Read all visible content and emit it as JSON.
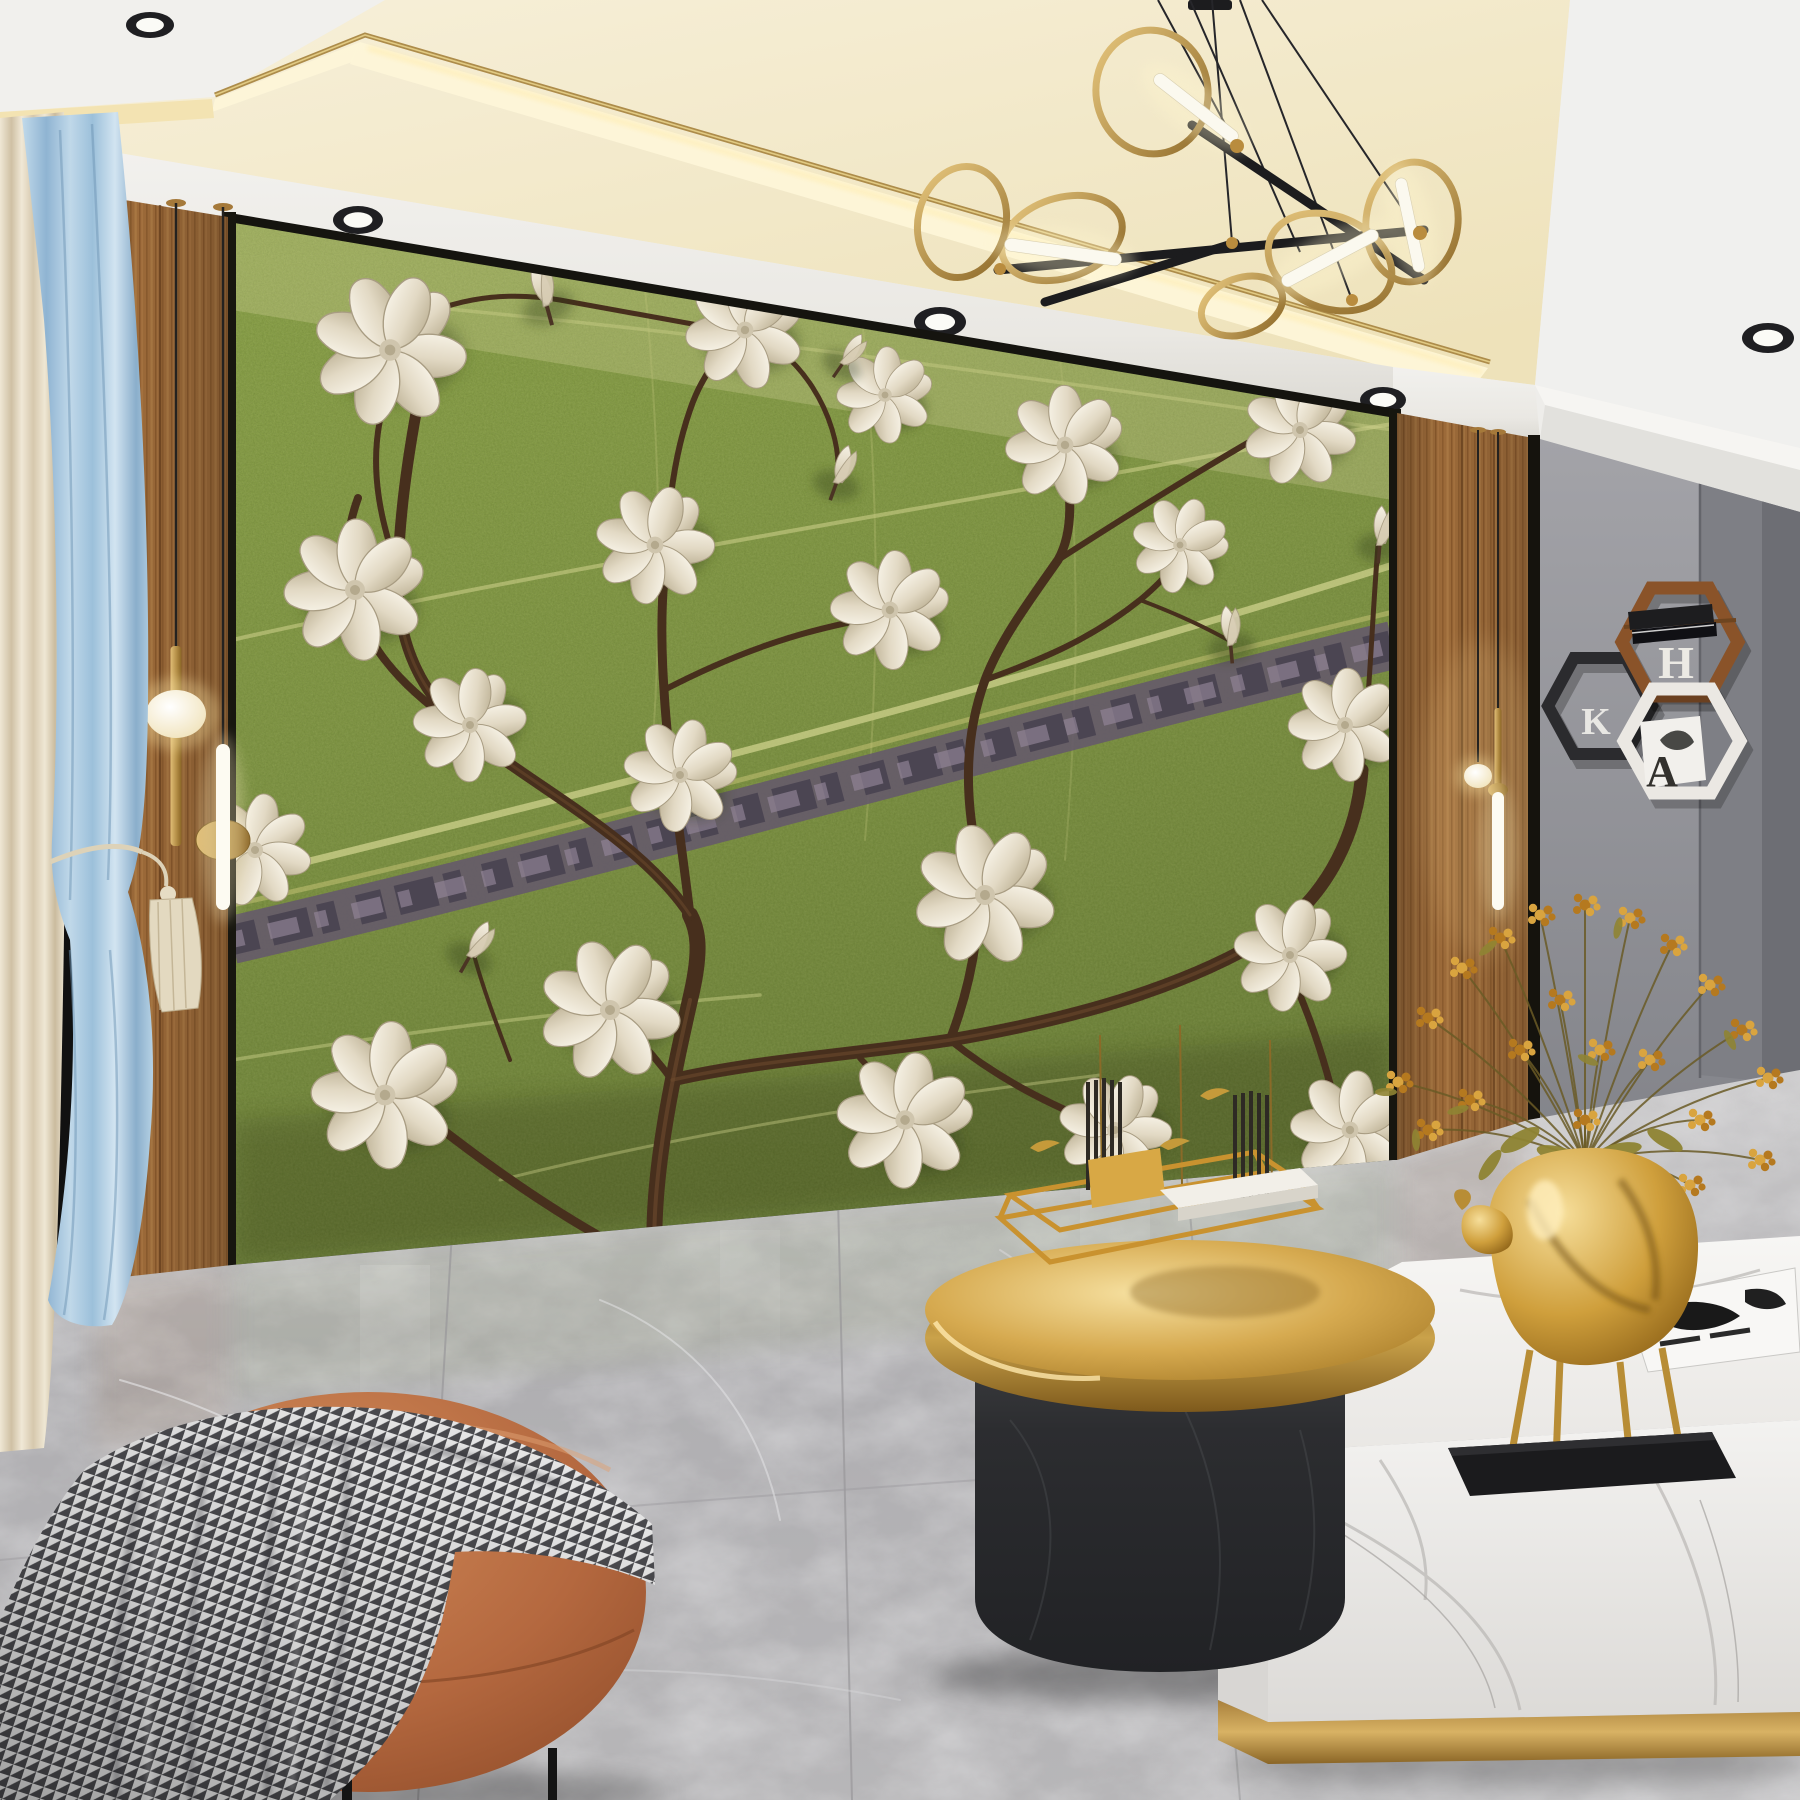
{
  "scene": {
    "description": "Modern living room render: green leaf-texture feature wall with embossed white magnolia branches, flanked by walnut wood panels, brass pendant lights, ring chandelier, gray marble floor, gold round coffee table with sculpture, white marble table with gold deer vase and yellow berry arrangement, caramel ottoman with houndstooth throw, blue and cream curtains, hexagon wall shelves."
  },
  "shelves": {
    "letter_top": "H",
    "letter_left": "K",
    "letter_bottom": "A"
  },
  "palette": {
    "ceiling_white": "#f1f0ed",
    "ceiling_cream": "#f6efd8",
    "cove_glow": "#fdf6d8",
    "gold_trim": "#ad8c4a",
    "mural_green": "#7d9440",
    "mural_green_dark": "#5d7030",
    "vein_yellow": "#cfd28c",
    "midrib_purple": "#655a6a",
    "branch_brown": "#472f1d",
    "petal_cream": "#f3eee1",
    "wood": "#9c6a39",
    "gray_wall": "#9c9ba0",
    "floor_gray": "#b4b3b5",
    "curtain_blue": "#a9c9e0",
    "curtain_cream": "#e9e0cc",
    "ottoman": "#b4683f",
    "blanket_dark": "#4a4a4e",
    "gold_bright": "#e8c06c",
    "black_marble": "#2d2e31",
    "white_marble": "#f5f4f2",
    "deer_gold": "#cf9f3c",
    "berry_yellow": "#d9a43f"
  },
  "ceiling": {
    "spotlights": [
      {
        "x": 150,
        "y": 25,
        "rx": 24,
        "ry": 13
      },
      {
        "x": 358,
        "y": 220,
        "rx": 25,
        "ry": 14
      },
      {
        "x": 940,
        "y": 322,
        "rx": 26,
        "ry": 15
      },
      {
        "x": 1383,
        "y": 400,
        "rx": 23,
        "ry": 13
      },
      {
        "x": 1768,
        "y": 338,
        "rx": 26,
        "ry": 15
      }
    ]
  },
  "chandelier": {
    "wires": [
      [
        1158,
        0,
        1237,
        146
      ],
      [
        1190,
        0,
        1300,
        252
      ],
      [
        1212,
        0,
        1232,
        242
      ],
      [
        1240,
        0,
        1352,
        300
      ],
      [
        1262,
        0,
        1420,
        235
      ]
    ],
    "bars": [
      [
        998,
        270,
        1424,
        230
      ],
      [
        1192,
        125,
        1424,
        280
      ],
      [
        1045,
        302,
        1235,
        243
      ]
    ],
    "rings": [
      {
        "cx": 1152,
        "cy": 92,
        "rx": 56,
        "ry": 62,
        "rot": -8
      },
      {
        "cx": 1062,
        "cy": 238,
        "rx": 62,
        "ry": 40,
        "rot": -18
      },
      {
        "cx": 962,
        "cy": 222,
        "rx": 44,
        "ry": 56,
        "rot": 12
      },
      {
        "cx": 1330,
        "cy": 262,
        "rx": 64,
        "ry": 46,
        "rot": 22
      },
      {
        "cx": 1412,
        "cy": 222,
        "rx": 46,
        "ry": 60,
        "rot": 6
      },
      {
        "cx": 1242,
        "cy": 306,
        "rx": 42,
        "ry": 28,
        "rot": -20
      }
    ],
    "tubes": [
      {
        "cx": 1196,
        "cy": 108,
        "len": 104,
        "w": 13,
        "rot": 38
      },
      {
        "cx": 1063,
        "cy": 252,
        "len": 118,
        "w": 13,
        "rot": 8
      },
      {
        "cx": 1330,
        "cy": 258,
        "len": 108,
        "w": 13,
        "rot": -28
      },
      {
        "cx": 1410,
        "cy": 225,
        "len": 96,
        "w": 12,
        "rot": 78
      }
    ],
    "joints": [
      [
        1237,
        146,
        7
      ],
      [
        1000,
        269,
        6
      ],
      [
        1352,
        300,
        6
      ],
      [
        1420,
        233,
        7
      ],
      [
        1232,
        243,
        6
      ]
    ]
  },
  "mural": {
    "flowers": [
      {
        "x": 390,
        "y": 350,
        "s": 1.35,
        "r": -15
      },
      {
        "x": 355,
        "y": 590,
        "s": 1.25,
        "r": 10
      },
      {
        "x": 470,
        "y": 725,
        "s": 1.0,
        "r": -30
      },
      {
        "x": 255,
        "y": 850,
        "s": 1.0,
        "r": 160
      },
      {
        "x": 385,
        "y": 1095,
        "s": 1.3,
        "r": 15
      },
      {
        "x": 610,
        "y": 1010,
        "s": 1.25,
        "r": -10
      },
      {
        "x": 680,
        "y": 775,
        "s": 1.0,
        "r": 25
      },
      {
        "x": 655,
        "y": 545,
        "s": 1.05,
        "r": -20
      },
      {
        "x": 745,
        "y": 330,
        "s": 1.05,
        "r": 5
      },
      {
        "x": 890,
        "y": 610,
        "s": 1.05,
        "r": 15
      },
      {
        "x": 985,
        "y": 895,
        "s": 1.25,
        "r": -5
      },
      {
        "x": 905,
        "y": 1120,
        "s": 1.2,
        "r": 20
      },
      {
        "x": 1115,
        "y": 1130,
        "s": 1.0,
        "r": -18
      },
      {
        "x": 1065,
        "y": 445,
        "s": 1.05,
        "r": 8
      },
      {
        "x": 1180,
        "y": 545,
        "s": 0.85,
        "r": 30
      },
      {
        "x": 1300,
        "y": 430,
        "s": 1.0,
        "r": -8
      },
      {
        "x": 1345,
        "y": 725,
        "s": 1.0,
        "r": 12
      },
      {
        "x": 1290,
        "y": 955,
        "s": 1.0,
        "r": -22
      },
      {
        "x": 1350,
        "y": 1130,
        "s": 1.05,
        "r": 18
      },
      {
        "x": 885,
        "y": 395,
        "s": 0.85,
        "r": 12
      }
    ],
    "buds": [
      {
        "x": 545,
        "y": 300,
        "s": 1.0,
        "r": -20
      },
      {
        "x": 838,
        "y": 478,
        "s": 0.9,
        "r": 15
      },
      {
        "x": 1230,
        "y": 640,
        "s": 0.9,
        "r": -10
      },
      {
        "x": 472,
        "y": 952,
        "s": 0.9,
        "r": 25
      },
      {
        "x": 1380,
        "y": 540,
        "s": 0.9,
        "r": 0
      },
      {
        "x": 845,
        "y": 360,
        "s": 0.8,
        "r": 30
      }
    ]
  },
  "vase": {
    "clusters": [
      [
        1398,
        1082
      ],
      [
        1428,
        1018
      ],
      [
        1462,
        968
      ],
      [
        1500,
        938
      ],
      [
        1540,
        915
      ],
      [
        1585,
        905
      ],
      [
        1630,
        918
      ],
      [
        1672,
        945
      ],
      [
        1710,
        985
      ],
      [
        1742,
        1030
      ],
      [
        1768,
        1078
      ],
      [
        1560,
        1000
      ],
      [
        1600,
        1050
      ],
      [
        1520,
        1050
      ],
      [
        1650,
        1060
      ],
      [
        1470,
        1100
      ],
      [
        1700,
        1120
      ],
      [
        1585,
        1120
      ],
      [
        1540,
        1170
      ],
      [
        1630,
        1170
      ],
      [
        1690,
        1185
      ],
      [
        1428,
        1130
      ],
      [
        1760,
        1160
      ]
    ]
  }
}
